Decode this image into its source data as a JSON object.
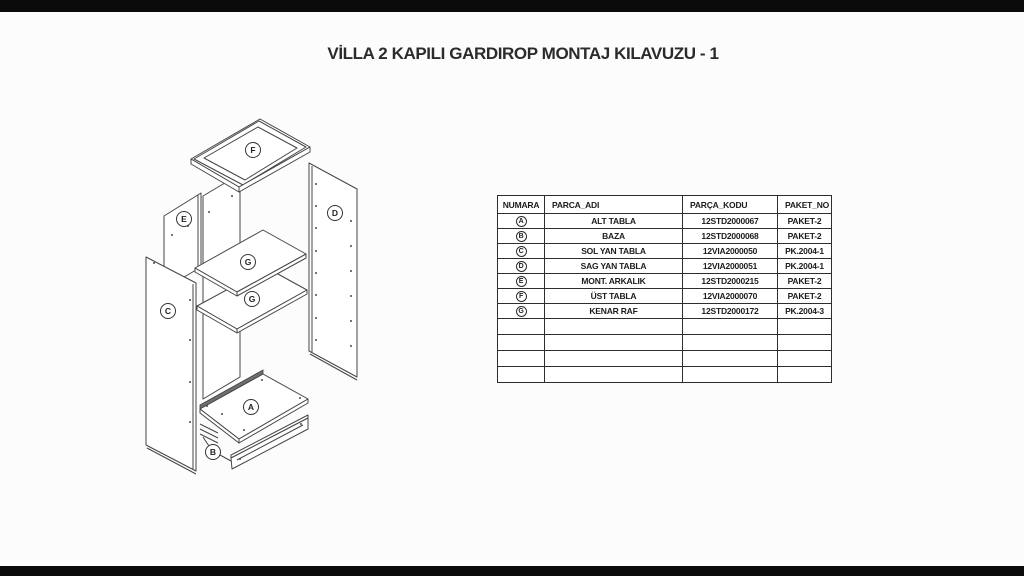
{
  "page": {
    "title": "VİLLA 2 KAPILI GARDIROP MONTAJ KILAVUZU - 1"
  },
  "colors": {
    "paper": "#fcfcfc",
    "letterbox": "#0b0b0b",
    "line": "#454545",
    "text": "#1c1c1c"
  },
  "diagram": {
    "callouts": [
      {
        "letter": "F"
      },
      {
        "letter": "E"
      },
      {
        "letter": "D"
      },
      {
        "letter": "G"
      },
      {
        "letter": "G"
      },
      {
        "letter": "C"
      },
      {
        "letter": "A"
      },
      {
        "letter": "B"
      }
    ]
  },
  "table": {
    "headers": [
      "NUMARA",
      "PARCA_ADI",
      "PARÇA_KODU",
      "PAKET_NO"
    ],
    "rows": [
      {
        "numara": "A",
        "parca_adi": "ALT TABLA",
        "parca_kodu": "12STD2000067",
        "paket_no": "PAKET-2"
      },
      {
        "numara": "B",
        "parca_adi": "BAZA",
        "parca_kodu": "12STD2000068",
        "paket_no": "PAKET-2"
      },
      {
        "numara": "C",
        "parca_adi": "SOL YAN TABLA",
        "parca_kodu": "12VIA2000050",
        "paket_no": "PK.2004-1"
      },
      {
        "numara": "D",
        "parca_adi": "SAG YAN TABLA",
        "parca_kodu": "12VIA2000051",
        "paket_no": "PK.2004-1"
      },
      {
        "numara": "E",
        "parca_adi": "MONT. ARKALIK",
        "parca_kodu": "12STD2000215",
        "paket_no": "PAKET-2"
      },
      {
        "numara": "F",
        "parca_adi": "ÜST TABLA",
        "parca_kodu": "12VIA2000070",
        "paket_no": "PAKET-2"
      },
      {
        "numara": "G",
        "parca_adi": "KENAR RAF",
        "parca_kodu": "12STD2000172",
        "paket_no": "PK.2004-3"
      }
    ],
    "empty_row_count": 4
  }
}
